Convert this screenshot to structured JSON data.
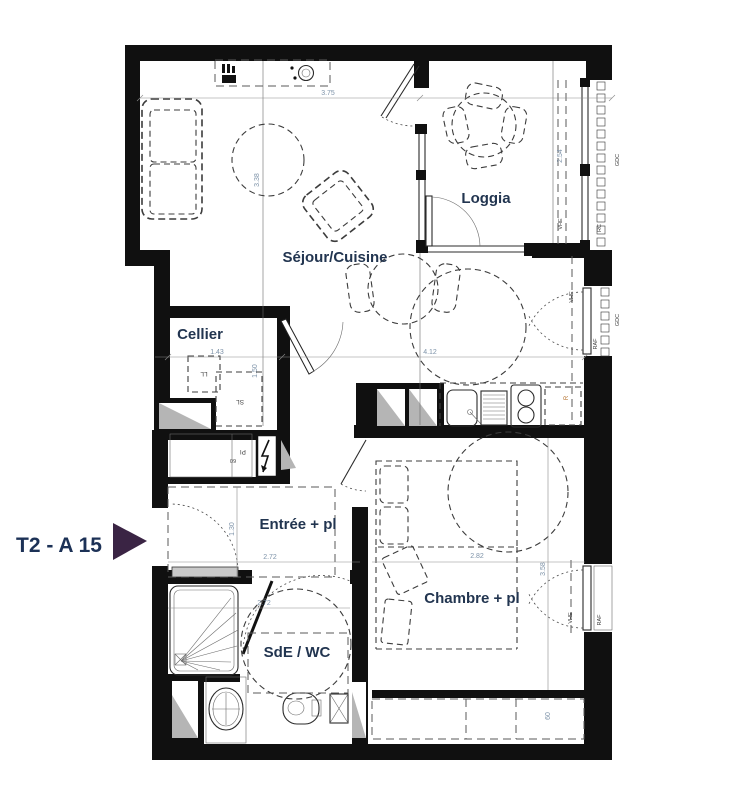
{
  "unit": {
    "label": "T2 - A 15"
  },
  "rooms": {
    "sejour": "Séjour/Cuisine",
    "loggia": "Loggia",
    "cellier": "Cellier",
    "entree": "Entrée + pl",
    "chambre": "Chambre + pl",
    "sde": "SdE / WC"
  },
  "dimensions": {
    "sejour_width": "3.75",
    "sejour_depth": "3.38",
    "loggia_depth": "2.54",
    "cellier_width": "1.43",
    "kitchen_width": "4.12",
    "cellier_depth": "1.50",
    "entree_width": "2.72",
    "entree_depth": "1.30",
    "chambre_width": "2.82",
    "chambre_depth": "3.58",
    "sde_width": "2.72",
    "wardrobe_depth": "60",
    "closet_depth": "60"
  },
  "equipment": {
    "washing_machine": "LL",
    "dryer": "SL",
    "closet": "Pl",
    "fridge": "R"
  },
  "facade_labels": {
    "loggia_shutter": "VHE",
    "loggia_rc": "RC",
    "loggia_railing": "GDC",
    "kitchen_shutter": "VHE",
    "kitchen_railing": "GDC",
    "kitchen_raf": "RAF",
    "chambre_shutter": "VHE",
    "chambre_raf": "RAF"
  },
  "colors": {
    "wall": "#101010",
    "unit_text": "#1c3156",
    "arrow": "#3a2444",
    "dimension_text": "#7e93a9",
    "room_text": "#223550"
  }
}
